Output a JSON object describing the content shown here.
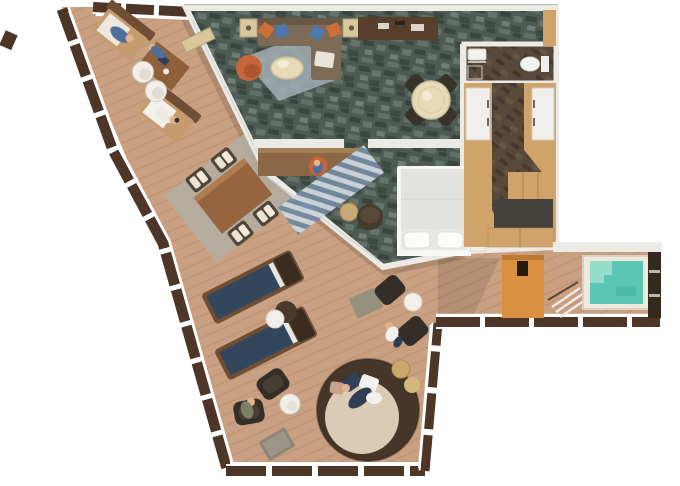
{
  "page": {
    "type": "floor-plan",
    "subject": "cruise-ship-suite-with-wraparound-balcony-and-hot-tub"
  },
  "plan": {
    "rooms": [
      "living-room",
      "dining-area",
      "bedroom",
      "bathroom",
      "wardrobe-corridor",
      "entry-vestibule",
      "wraparound-balcony",
      "hot-tub-terrace"
    ],
    "furniture": [
      "sectional-sofa",
      "media-console",
      "table-lamp",
      "round-armchair",
      "coffee-table",
      "round-dining-table",
      "dining-chair",
      "writing-desk",
      "desk-chair",
      "double-bed",
      "bed-pillow",
      "nightstand",
      "side-table",
      "dresser",
      "wardrobe",
      "sink",
      "toilet",
      "privacy-screen",
      "terrace-steps",
      "hot-tub",
      "deck-lounge-chair",
      "deck-stool",
      "outdoor-dining-set",
      "sun-lounger",
      "lounger-side-table",
      "outdoor-armchair",
      "outdoor-ottoman",
      "outdoor-coffee-table",
      "round-daybed",
      "deck-railing"
    ]
  },
  "colors": {
    "pageBg": "#ffffff",
    "deck": "#c9a081",
    "deckLine": "#b48a69",
    "rail": "#4d3627",
    "railInner": "#ffffff",
    "wall": "#eceae5",
    "wallEdge": "#b9b6b0",
    "carpet": "#4e5a54",
    "carpetDark": "#39453f",
    "carpetLight": "#66756c",
    "carpetPale": "#8b9890",
    "wood": "#cfa36a",
    "woodLine": "#ab824c",
    "corridorA": "#57483a",
    "corridorB": "#43362a",
    "corridorC": "#6d5c47",
    "orangeScreen": "#d9903f",
    "orangeScreenDark": "#b06f28",
    "tubWater": "#5cc6b4",
    "tubLight": "#96ddc9",
    "tubFrame": "#efe9dd",
    "darkWall": "#35291e",
    "bedBase": "#e7e7e4",
    "bedFrame": "#f7f7f5",
    "pillow": "#fcfcfb",
    "sofa": "#7d6a57",
    "sofaDark": "#685845",
    "pillowOrange": "#cf6f38",
    "pillowBlue": "#4d79ae",
    "chairOrange": "#c4663a",
    "tableCream": "#e8dab6",
    "darkChair": "#37332b",
    "loungerNavy": "#32465e",
    "loungerStripe": "#e6e6e4",
    "loungerFrame": "#6f4e33",
    "loungerHead": "#3a2c1e",
    "matGray": "#b3aca0",
    "cushionCream": "#eae3d1",
    "outdoorTable": "#96653f",
    "rugLiving": "#a3aeb4",
    "rugStripeA": "#cdd6dc",
    "rugStripeB": "#7289a0",
    "daybedRing": "#46362a",
    "daybedCushion": "#dbcbb5",
    "whiteTable": "#f2efe9",
    "ottomanGray": "#96907f",
    "skin": "#e2b38e",
    "figureBlue": "#4e6e9e",
    "figureNavy": "#2e3f55",
    "figureWhite": "#f1f1ee",
    "figureGreen": "#7e8064",
    "entryDark": "#45413c",
    "dresserDark": "#2c2925",
    "deskBrown": "#8a6747",
    "stoolTan": "#c9a878",
    "sideTableDark": "#4a3828",
    "lampTable": "#d9c79c"
  }
}
